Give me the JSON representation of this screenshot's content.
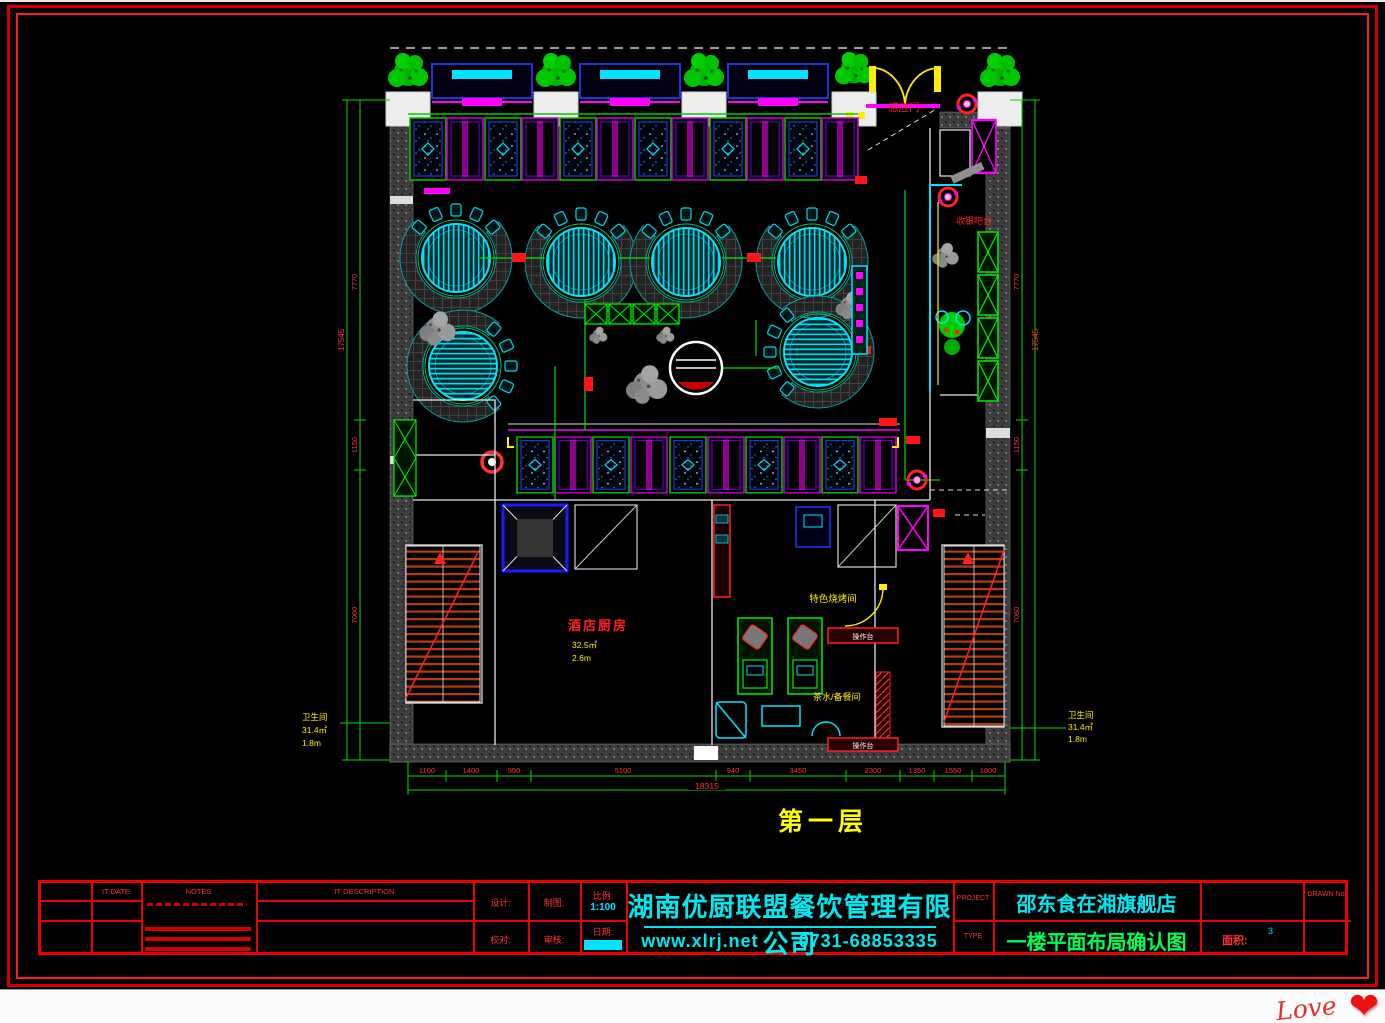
{
  "plan": {
    "floor_label": "第一层",
    "labels": {
      "auto_door": "感应门",
      "cashier": "收银吧台",
      "kitchen": "酒店厨房",
      "kitchen_area": "32.5㎡",
      "kitchen_height": "2.6m",
      "special_room": "特色烧烤间",
      "pantry": "茶水/备餐间",
      "worktop_upper": "操作台",
      "worktop_lower": "操作台",
      "toilet_left_name": "卫生间",
      "toilet_left_area": "31.4㎡",
      "toilet_left_height": "1.8m",
      "toilet_right_name": "卫生间",
      "toilet_right_area": "31.4㎡",
      "toilet_right_height": "1.8m"
    },
    "dimensions": {
      "bottom_segments": [
        "1100",
        "1400",
        "950",
        "5100",
        "940",
        "3450",
        "2300",
        "1350",
        "1550",
        "1800"
      ],
      "bottom_total": "18315",
      "left_segments": [
        "7770",
        "1150",
        "7060"
      ],
      "left_total": "17545",
      "right_segments": [
        "7770",
        "1150",
        "7060"
      ],
      "right_total": "17545"
    },
    "colors": {
      "line_green": "#00dd00",
      "cyan": "#00e5ff",
      "magenta": "#ff00ff",
      "yellow": "#ffee00",
      "red": "#ff2222"
    }
  },
  "titleblock": {
    "rev": {
      "col_date": "IT DATE",
      "col_notes": "NOTES",
      "col_desc": "IT DESCRIPTION"
    },
    "fields": {
      "design": "设计:",
      "draft": "制图:",
      "scale": "比例:",
      "scale_value": "1:100",
      "check": "校对:",
      "audit": "审核:",
      "date": "日期:"
    },
    "company": {
      "name": "湖南优厨联盟餐饮管理有限公司",
      "website": "www.xlrj.net",
      "phone": "0731-68853335"
    },
    "project": {
      "label": "PROJECT",
      "name": "邵东食在湘旗舰店"
    },
    "sheet": {
      "label": "TYPE",
      "name": "一楼平面布局确认图"
    },
    "area": {
      "label": "面积:",
      "value": "3"
    },
    "drawn_no": {
      "label": "DRAWN No."
    }
  },
  "signature": {
    "text": "Love",
    "heart": "❤"
  }
}
